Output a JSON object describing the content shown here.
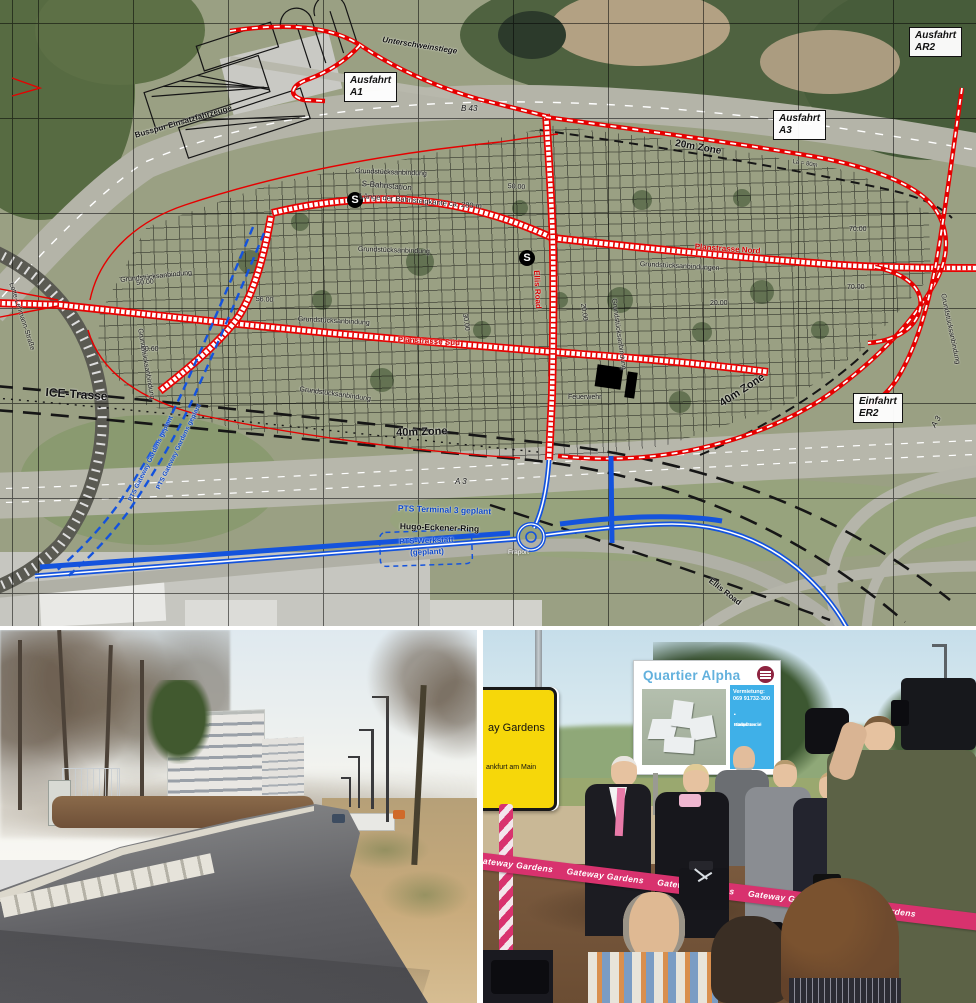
{
  "colors": {
    "map_red": "#e60000",
    "map_blue": "#1453dd",
    "ribbon_pink": "#d8326e",
    "sign_yellow": "#f6d70a",
    "billboard_panel_blue": "#3fb0e8",
    "billboard_title_blue": "#63b1dd",
    "logo_maroon": "#8e2440"
  },
  "map": {
    "station_symbol": "S",
    "station_icons": [
      {
        "x": 347,
        "y": 192
      },
      {
        "x": 519,
        "y": 250
      }
    ],
    "boxed_labels": [
      {
        "id": "ausfahrt-a1",
        "lines": [
          "Ausfahrt",
          "A1"
        ],
        "x": 344,
        "y": 72
      },
      {
        "id": "ausfahrt-ar2",
        "lines": [
          "Ausfahrt",
          "AR2"
        ],
        "x": 909,
        "y": 27
      },
      {
        "id": "ausfahrt-a3",
        "lines": [
          "Ausfahrt",
          "A3"
        ],
        "x": 773,
        "y": 110
      },
      {
        "id": "einfahrt-er2",
        "lines": [
          "Einfahrt",
          "ER2"
        ],
        "x": 853,
        "y": 393
      }
    ],
    "labels": [
      {
        "t": "Unterschweinstiege",
        "x": 383,
        "y": 36,
        "r": 9,
        "s": 8,
        "c": "k",
        "b": 1,
        "i": 1
      },
      {
        "t": "B 43",
        "x": 461,
        "y": 105,
        "r": 0,
        "s": 8,
        "c": "k",
        "i": 1
      },
      {
        "t": "Busspur Einsatzfahrzeuge",
        "x": 134,
        "y": 132,
        "r": -16,
        "s": 8,
        "c": "k",
        "b": 1
      },
      {
        "t": "S-Bahnstation",
        "x": 362,
        "y": 180,
        "r": 5,
        "s": 8,
        "c": "k"
      },
      {
        "t": "Länge der Bahnsteigkante ca. 280 m",
        "x": 360,
        "y": 192,
        "r": 5,
        "s": 7.5,
        "c": "k"
      },
      {
        "t": "20m Zone",
        "x": 676,
        "y": 139,
        "r": 10,
        "s": 10,
        "c": "k",
        "b": 1
      },
      {
        "t": "La = 80m",
        "x": 793,
        "y": 159,
        "r": 9,
        "s": 6,
        "c": "k"
      },
      {
        "t": "Grundstücksanbindung",
        "x": 355,
        "y": 168,
        "r": 2,
        "s": 7,
        "c": "k"
      },
      {
        "t": "Grundstücksanbindung",
        "x": 358,
        "y": 246,
        "r": 2,
        "s": 7,
        "c": "k"
      },
      {
        "t": "Grundstücksanbindung",
        "x": 298,
        "y": 316,
        "r": 3,
        "s": 7,
        "c": "k"
      },
      {
        "t": "Grundstücksanbindung",
        "x": 120,
        "y": 277,
        "r": -6,
        "s": 7,
        "c": "k"
      },
      {
        "t": "Grundstücksanbindungen",
        "x": 640,
        "y": 261,
        "r": 3,
        "s": 7,
        "c": "k"
      },
      {
        "t": "Grundstücksanbindung",
        "x": 143,
        "y": 328,
        "r": 80,
        "s": 7,
        "c": "k"
      },
      {
        "t": "Grundstücksanbindung",
        "x": 617,
        "y": 298,
        "r": 82,
        "s": 7,
        "c": "k"
      },
      {
        "t": "Grundstücksanbindung",
        "x": 946,
        "y": 293,
        "r": 78,
        "s": 7,
        "c": "k"
      },
      {
        "t": "Grundstücksanbindung",
        "x": 300,
        "y": 386,
        "r": 8,
        "s": 7,
        "c": "k"
      },
      {
        "t": "50.00",
        "x": 136,
        "y": 280,
        "r": -5,
        "s": 7,
        "c": "k"
      },
      {
        "t": "50.00",
        "x": 508,
        "y": 183,
        "r": 4,
        "s": 7,
        "c": "k"
      },
      {
        "t": "56.00",
        "x": 256,
        "y": 296,
        "r": 3,
        "s": 7,
        "c": "k"
      },
      {
        "t": "50.60",
        "x": 141,
        "y": 346,
        "r": 0,
        "s": 7,
        "c": "k"
      },
      {
        "t": "20.00",
        "x": 586,
        "y": 303,
        "r": 82,
        "s": 7,
        "c": "k"
      },
      {
        "t": "20.00",
        "x": 710,
        "y": 300,
        "r": 0,
        "s": 7,
        "c": "k"
      },
      {
        "t": "30.00",
        "x": 468,
        "y": 313,
        "r": 82,
        "s": 7,
        "c": "k"
      },
      {
        "t": "70.00",
        "x": 849,
        "y": 226,
        "r": 0,
        "s": 7,
        "c": "k"
      },
      {
        "t": "70.00",
        "x": 847,
        "y": 284,
        "r": 0,
        "s": 7,
        "c": "k"
      },
      {
        "t": "ICE-Trasse",
        "x": 46,
        "y": 386,
        "r": 4,
        "s": 12,
        "c": "k",
        "b": 1
      },
      {
        "t": "40m Zone",
        "x": 396,
        "y": 428,
        "r": -2,
        "s": 11,
        "c": "k",
        "b": 1
      },
      {
        "t": "40m Zone",
        "x": 718,
        "y": 400,
        "r": -33,
        "s": 11,
        "c": "k",
        "b": 1
      },
      {
        "t": "A 3",
        "x": 455,
        "y": 478,
        "r": 0,
        "s": 8,
        "c": "k",
        "i": 1
      },
      {
        "t": "A 3",
        "x": 930,
        "y": 425,
        "r": -60,
        "s": 8,
        "c": "k",
        "i": 1
      },
      {
        "t": "Planstrasse Nord",
        "x": 695,
        "y": 243,
        "r": 4,
        "s": 8,
        "c": "r",
        "b": 1
      },
      {
        "t": "Planstrasse Süd",
        "x": 398,
        "y": 336,
        "r": 3,
        "s": 8,
        "c": "r",
        "b": 1
      },
      {
        "t": "Ellis Road",
        "x": 540,
        "y": 270,
        "r": 87,
        "s": 8,
        "c": "r",
        "b": 1
      },
      {
        "t": "Ellis Road",
        "x": 712,
        "y": 577,
        "r": 38,
        "s": 8,
        "c": "k",
        "b": 1
      },
      {
        "t": "Feuerwehr",
        "x": 568,
        "y": 394,
        "r": 0,
        "s": 7,
        "c": "k"
      },
      {
        "t": "Fraport",
        "x": 508,
        "y": 550,
        "r": 0,
        "s": 6.5,
        "c": "w"
      },
      {
        "t": "PTS Terminal 3 geplant",
        "x": 398,
        "y": 504,
        "r": 2,
        "s": 8.5,
        "c": "b",
        "b": 1
      },
      {
        "t": "Hugo-Eckener-Ring",
        "x": 400,
        "y": 522,
        "r": 2,
        "s": 8.5,
        "c": "k",
        "b": 1
      },
      {
        "t": "PTS-Werkstatt",
        "x": 399,
        "y": 538,
        "r": -2,
        "s": 8,
        "c": "b",
        "b": 1
      },
      {
        "t": "(geplant)",
        "x": 410,
        "y": 549,
        "r": -2,
        "s": 8,
        "c": "b",
        "b": 1
      },
      {
        "t": "PTS Gateway Gardens geplant",
        "x": 128,
        "y": 500,
        "r": -64,
        "s": 6.5,
        "c": "b",
        "b": 1
      },
      {
        "t": "PTS Gateway Gardens geplant",
        "x": 156,
        "y": 488,
        "r": -64,
        "s": 6.5,
        "c": "b",
        "b": 1
      },
      {
        "t": "Lotte-Lehmann-Straße",
        "x": 14,
        "y": 282,
        "r": 72,
        "s": 7,
        "c": "k"
      }
    ]
  },
  "photo_right": {
    "town_sign": {
      "line1": "ay Gardens",
      "line2": "ankfurt am Main"
    },
    "billboard": {
      "title": "Quartier Alpha",
      "rental_label": "Vermietung:",
      "phone": "069 91732-300",
      "bullets": [
        "Büros",
        "Einzelhandel",
        "Gastronomie",
        "Stellplätze"
      ]
    },
    "ribbon_text": "Gateway Gardens",
    "ribbon_repeat": 5
  }
}
